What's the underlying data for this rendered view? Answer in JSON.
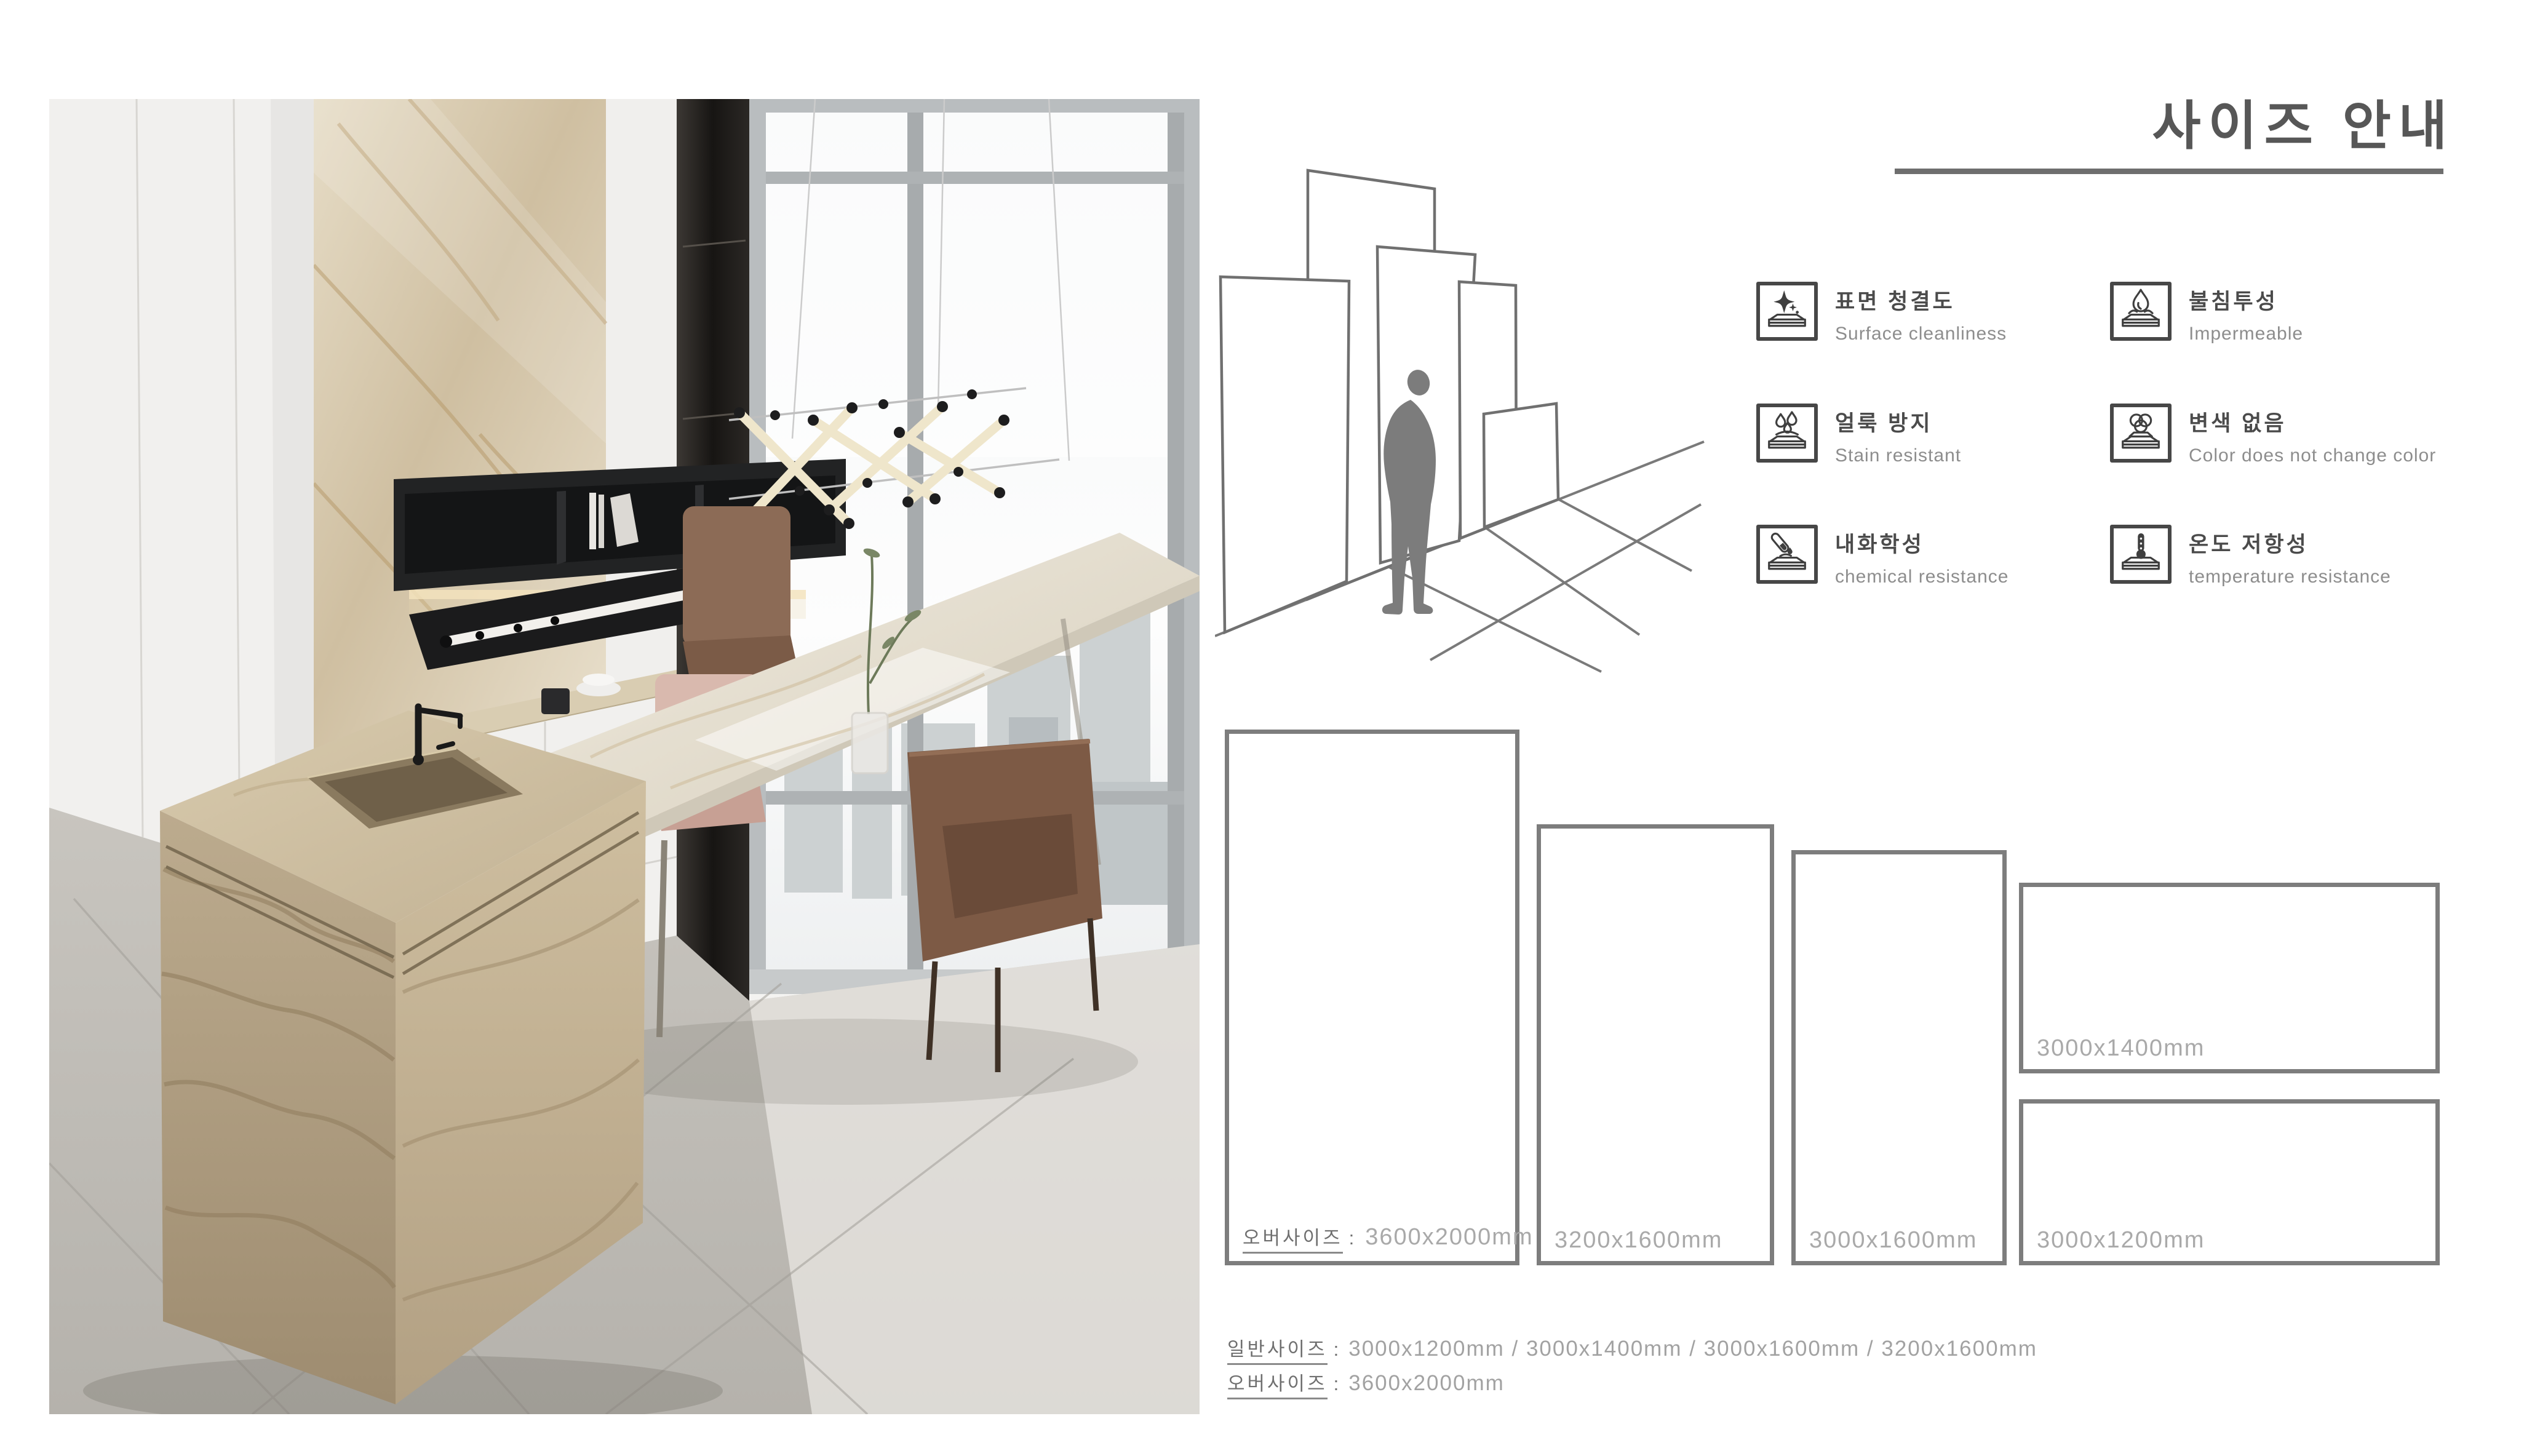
{
  "title": "사이즈 안내",
  "features": {
    "items": [
      {
        "ko": "표면 청결도",
        "en": "Surface cleanliness",
        "icon": "sparkle-slab-icon"
      },
      {
        "ko": "불침투성",
        "en": "Impermeable",
        "icon": "droplet-slab-icon"
      },
      {
        "ko": "얼룩 방지",
        "en": "Stain resistant",
        "icon": "stain-drops-slab-icon"
      },
      {
        "ko": "변색 없음",
        "en": "Color does not change color",
        "icon": "color-circles-slab-icon"
      },
      {
        "ko": "내화학성",
        "en": "chemical resistance",
        "icon": "test-tube-slab-icon"
      },
      {
        "ko": "온도 저항성",
        "en": "temperature resistance",
        "icon": "thermometer-slab-icon"
      }
    ]
  },
  "sizes": {
    "oversize_word": "오버사이즈",
    "colon": ":",
    "slabs": [
      {
        "label": "3600x2000mm",
        "oversize": true
      },
      {
        "label": "3200x1600mm"
      },
      {
        "label": "3000x1600mm"
      },
      {
        "label": "3000x1400mm"
      },
      {
        "label": "3000x1200mm"
      }
    ]
  },
  "summary": {
    "normal_word": "일반사이즈",
    "normal_colon": ":",
    "normal_value": "3000x1200mm / 3000x1400mm / 3000x1600mm / 3200x1600mm",
    "oversize_word": "오버사이즈",
    "oversize_colon": ":",
    "oversize_value": "3600x2000mm"
  },
  "colors": {
    "title_text": "#575757",
    "feature_ko_text": "#4b4b4b",
    "feature_en_text": "#8d8d8d",
    "size_label_text": "#a9a9a9",
    "underlined_label_text": "#6f6f6f",
    "rect_border": "#7d7d7d",
    "diagram_line": "#707070",
    "person_silhouette": "#7c7c7c"
  }
}
